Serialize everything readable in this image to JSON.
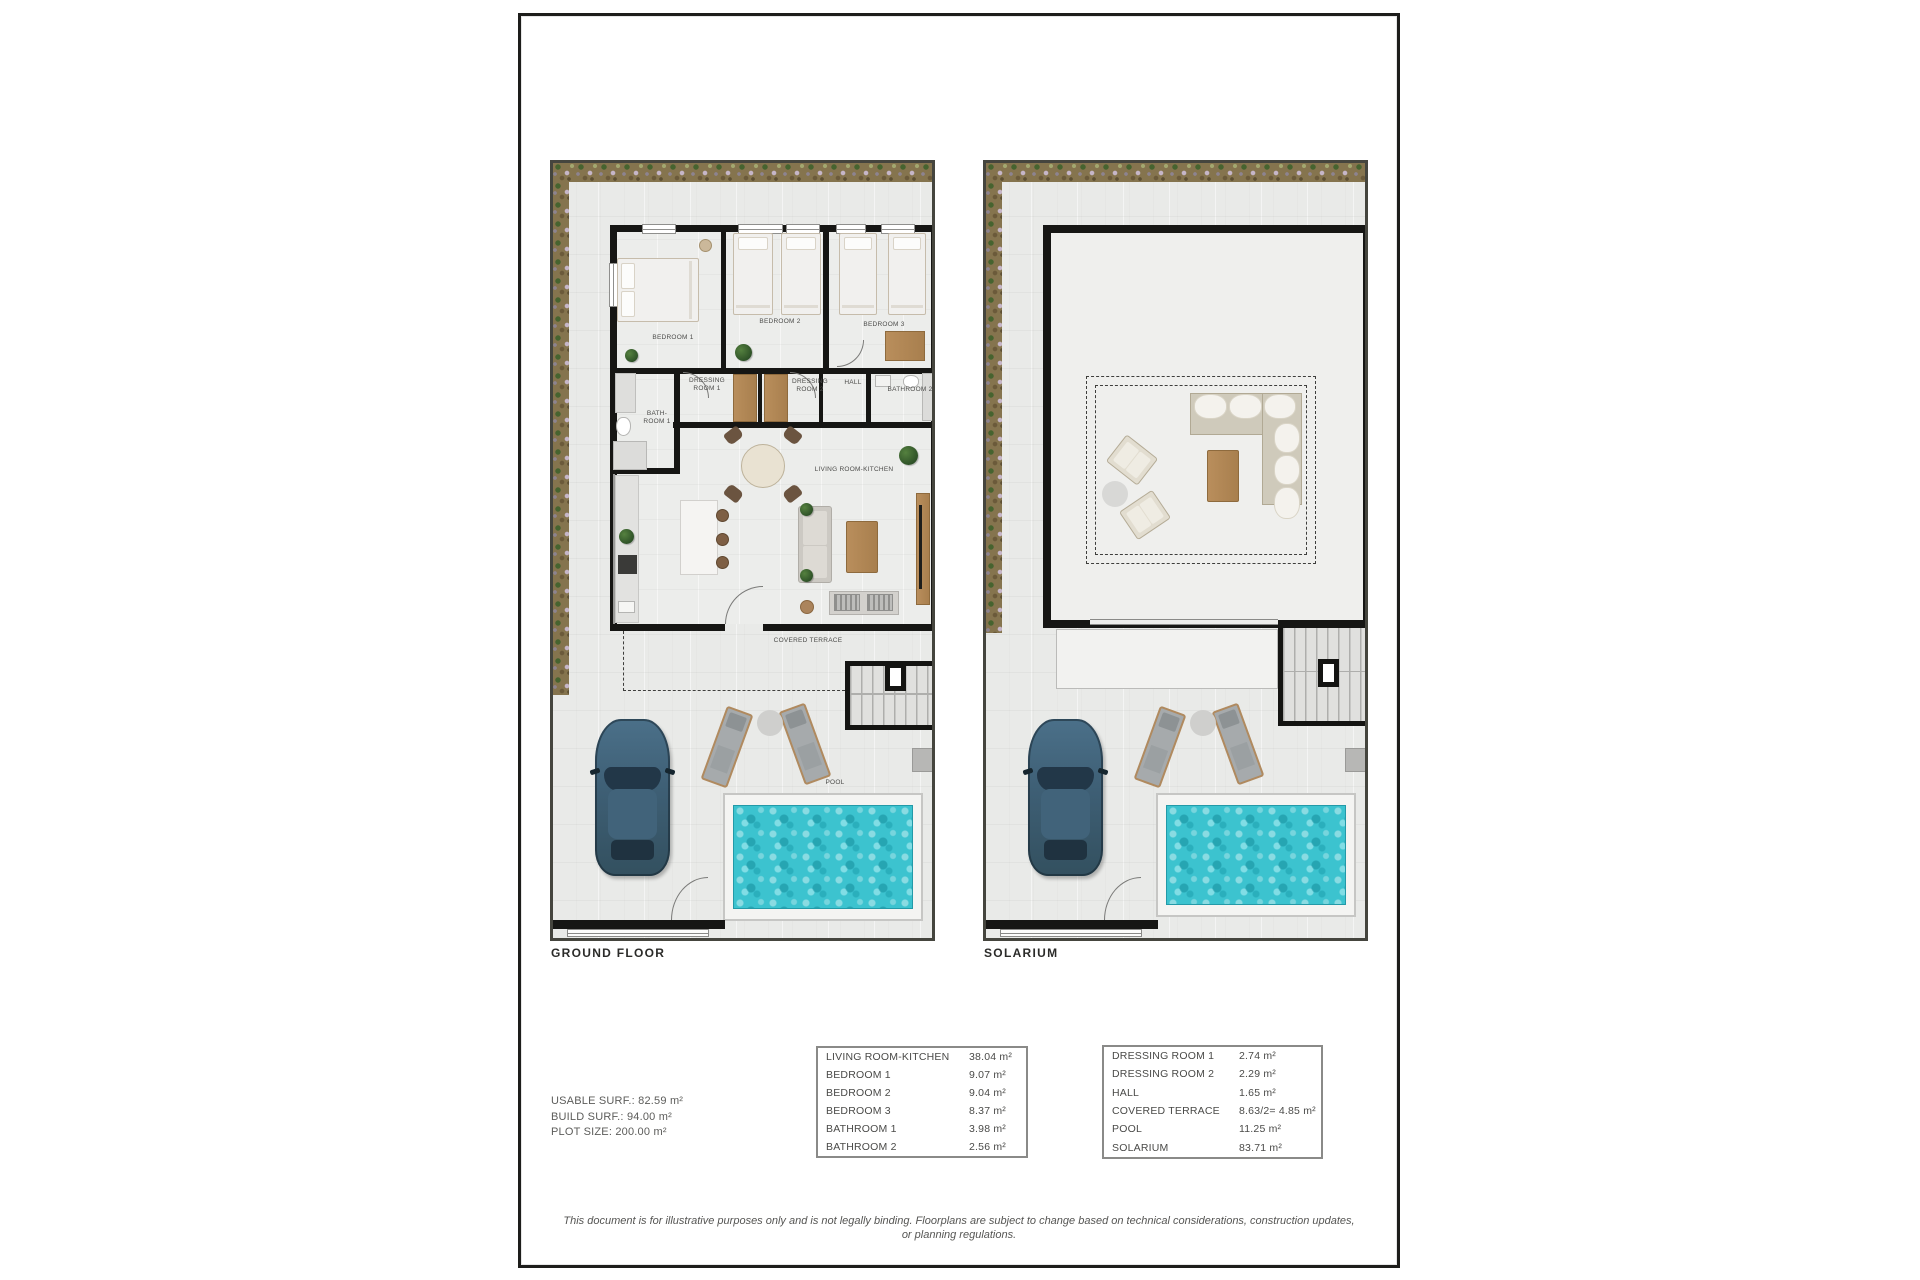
{
  "document": {
    "plans": [
      {
        "title": "GROUND FLOOR",
        "room_labels": [
          {
            "label": "BEDROOM 1"
          },
          {
            "label": "BEDROOM 2"
          },
          {
            "label": "BEDROOM 3"
          },
          {
            "label": "DRESSING\nROOM 1"
          },
          {
            "label": "DRESSING\nROOM 2"
          },
          {
            "label": "HALL"
          },
          {
            "label": "BATHROOM 2"
          },
          {
            "label": "BATH-\nROOM 1"
          },
          {
            "label": "LIVING ROOM-KITCHEN"
          },
          {
            "label": "COVERED TERRACE"
          },
          {
            "label": "POOL"
          }
        ]
      },
      {
        "title": "SOLARIUM",
        "room_labels": []
      }
    ],
    "summary": {
      "lines": [
        "USABLE SURF.: 82.59 m²",
        "BUILD SURF.: 94.00 m²",
        "PLOT SIZE: 200.00 m²"
      ]
    },
    "area_tables": [
      {
        "rows": [
          {
            "label": "LIVING ROOM-KITCHEN",
            "value": "38.04 m²"
          },
          {
            "label": "BEDROOM 1",
            "value": "9.07 m²"
          },
          {
            "label": "BEDROOM 2",
            "value": "9.04 m²"
          },
          {
            "label": "BEDROOM 3",
            "value": "8.37 m²"
          },
          {
            "label": "BATHROOM 1",
            "value": "3.98 m²"
          },
          {
            "label": "BATHROOM 2",
            "value": "2.56 m²"
          }
        ]
      },
      {
        "rows": [
          {
            "label": "DRESSING ROOM 1",
            "value": "2.74 m²"
          },
          {
            "label": "DRESSING ROOM 2",
            "value": "2.29 m²"
          },
          {
            "label": "HALL",
            "value": "1.65 m²"
          },
          {
            "label": "COVERED TERRACE",
            "value": "8.63/2= 4.85 m²"
          },
          {
            "label": "POOL",
            "value": "11.25 m²"
          },
          {
            "label": "SOLARIUM",
            "value": "83.71 m²"
          }
        ]
      }
    ],
    "disclaimer": "This document is for illustrative purposes only and is not legally binding. Floorplans are subject to change based on technical considerations, construction updates, or planning regulations.",
    "colors": {
      "wall": "#161614",
      "pool_water": "#3cc3cf",
      "garden": "#85744e",
      "terrace": "#e9eae8",
      "wood": "#b98e5c",
      "car_body": "#3e5f75"
    }
  }
}
